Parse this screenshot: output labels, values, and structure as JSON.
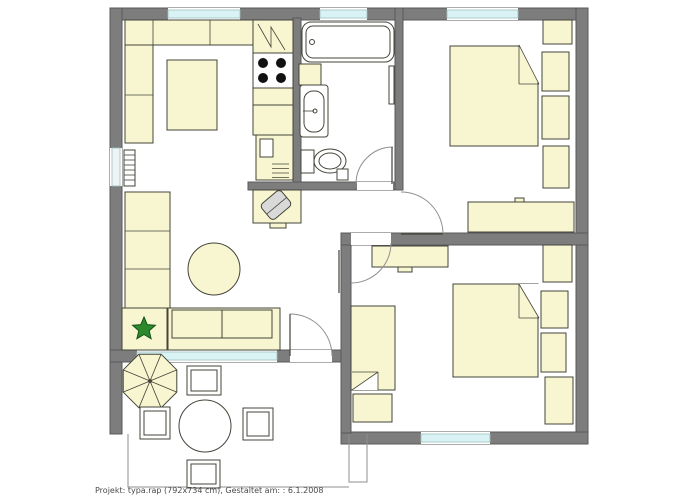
{
  "caption": {
    "text": "Projekt: typa.rap (792x734 cm), Gestaltet am: : 6.1.2008"
  },
  "palette": {
    "paper": "#ffffff",
    "wall": "#7d7d7d",
    "wall_edge": "#595959",
    "window": "#d9f2f3",
    "window_edge": "#9fbfbf",
    "furniture": "#f8f6d0",
    "outline": "#44443a",
    "thin": "#8f8f8f",
    "chair": "#d9d9d9",
    "plant": "#2c8a2c",
    "plant_dark": "#14521a",
    "caption_color": "#4a4a4a"
  },
  "plan": {
    "type": "apartment-floor-plan",
    "rooms": [
      {
        "name": "living-room",
        "furniture": [
          "corner-sofa",
          "coffee-table",
          "wall-shelf",
          "round-table",
          "sofa",
          "plant-table",
          "potted-plant",
          "radiator",
          "desk",
          "desk-chair"
        ]
      },
      {
        "name": "kitchen",
        "furniture": [
          "refrigerator",
          "stove-4-burner",
          "counter-cabinet",
          "counter-cabinet",
          "base-unit-with-vents"
        ]
      },
      {
        "name": "bathroom",
        "furniture": [
          "bathtub",
          "cabinet",
          "washbasin",
          "toilet",
          "towel-radiator",
          "floor-box"
        ]
      },
      {
        "name": "bedroom-top-right",
        "furniture": [
          "double-bed",
          "nightstand",
          "nightstand",
          "corner-cabinet",
          "cabinet",
          "dresser"
        ]
      },
      {
        "name": "bedroom-bottom-right",
        "furniture": [
          "double-bed",
          "single-bed",
          "nightstand",
          "nightstand",
          "desk",
          "corner-cabinet",
          "cabinet",
          "bedside-table"
        ]
      },
      {
        "name": "terrace",
        "furniture": [
          "parasol",
          "round-table",
          "garden-chair",
          "garden-chair",
          "garden-chair",
          "garden-chair"
        ]
      }
    ],
    "window_count": 6,
    "door_count": 4
  }
}
